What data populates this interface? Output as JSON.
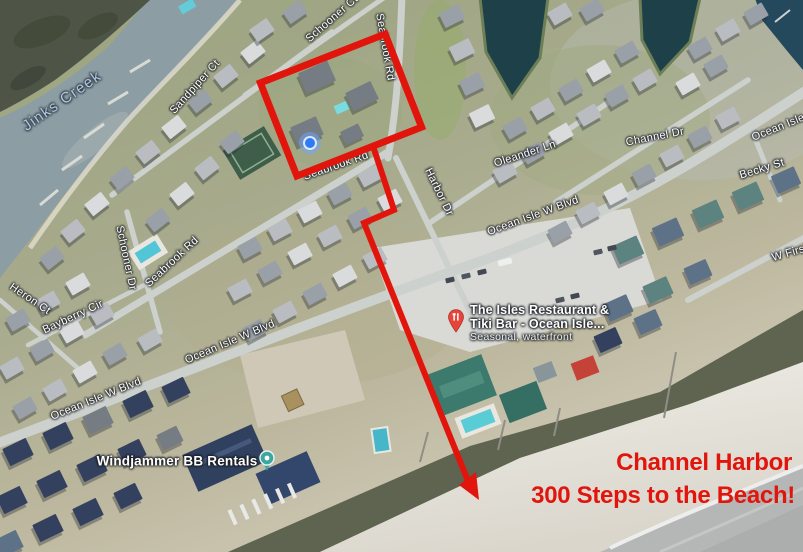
{
  "map": {
    "water_label": "Jinks Creek",
    "street_labels": {
      "schooner_ct": "Schooner Ct",
      "sandpiper_ct": "Sandpiper Ct",
      "seabrook_rd_vertical": "Seabrook Rd",
      "seabrook_rd_mid": "Seabrook Rd",
      "seabrook_rd_west": "Seabrook Rd",
      "schooner_dr": "Schooner Dr",
      "heron_ct": "Heron Ct",
      "bayberry_cir": "Bayberry Cir",
      "harbor_dr": "Harbor Dr",
      "oleander_ln": "Oleander Ln",
      "channel_dr": "Channel Dr",
      "becky_st": "Becky St",
      "ocean_isle_w_blvd_sw": "Ocean Isle W Blvd",
      "ocean_isle_w_blvd_mid": "Ocean Isle W Blvd",
      "ocean_isle_w_blvd_east": "Ocean Isle W Blvd",
      "ocean_isle_w_blvd_ne": "Ocean Isle W Blvd",
      "w_first_st": "W First St"
    },
    "places": {
      "windjammer": "Windjammer BB Rentals",
      "restaurant_line1": "The Isles Restaurant &",
      "restaurant_line2": "Tiki Bar - Ocean Isle...",
      "restaurant_line3": "Seasonal, waterfront"
    },
    "icons": {
      "property_marker": "blue-location-dot",
      "restaurant_marker": "red-restaurant-pin",
      "lodging_marker": "teal-place-pin"
    }
  },
  "annotations": {
    "line1": "Channel Harbor",
    "line2": "300 Steps to the Beach!",
    "highlight_color": "#e2150d"
  }
}
